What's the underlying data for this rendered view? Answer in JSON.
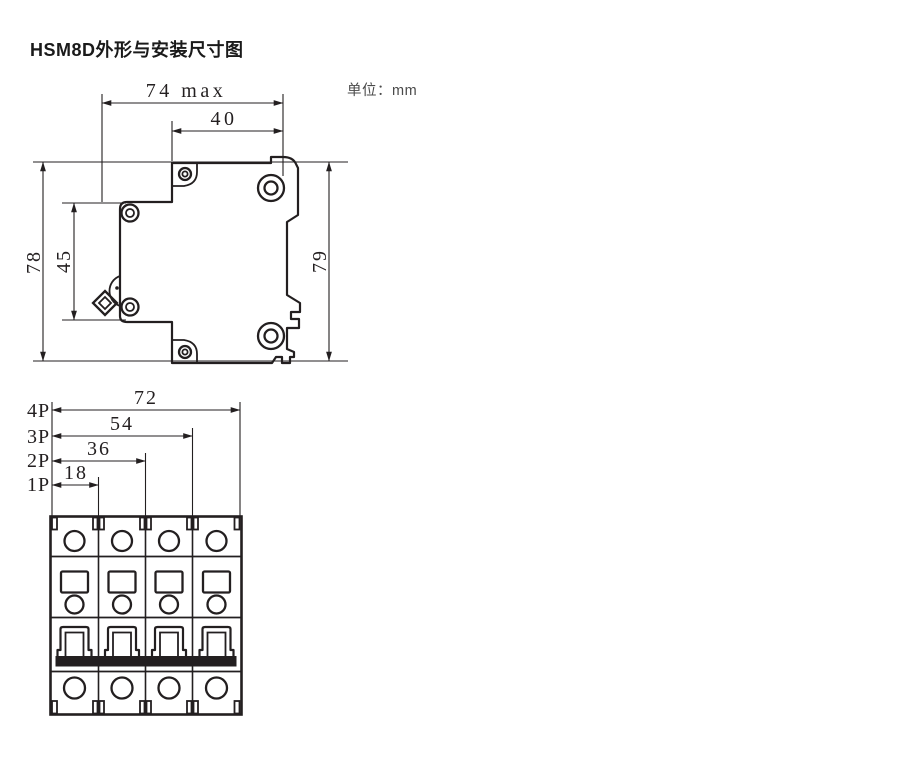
{
  "page": {
    "title": "HSM8D外形与安装尺寸图",
    "unit_label": "单位：mm"
  },
  "side_view": {
    "dims": {
      "overall_width": "74 max",
      "mounting_width": "40",
      "front_height": "78",
      "handle_span": "45",
      "overall_height": "79"
    }
  },
  "front_view": {
    "rows": [
      {
        "label": "4P",
        "value": "72"
      },
      {
        "label": "3P",
        "value": "54"
      },
      {
        "label": "2P",
        "value": "36"
      },
      {
        "label": "1P",
        "value": "18"
      }
    ]
  },
  "colors": {
    "line": "#231f20",
    "title_text": "#1a1a1a",
    "unit_text": "#4a4a4a"
  }
}
